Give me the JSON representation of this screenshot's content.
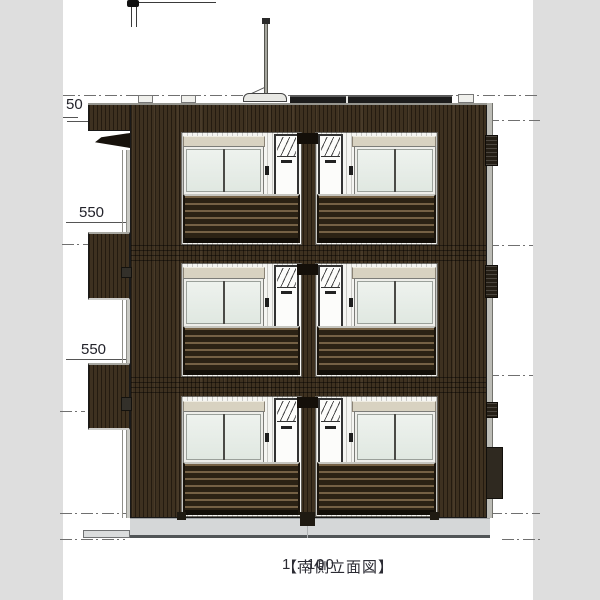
{
  "drawing": {
    "title": "【南側立面図】",
    "scale": "1 : 100",
    "dimensions": {
      "parapet": "50",
      "floor3": "550",
      "floor2": "550"
    },
    "colors": {
      "facade": "#3e3120",
      "railing": "#2b2214",
      "shutter_box": "#d8d2c1",
      "window_glass": "#e6ece6",
      "foundation": "#d5d7d8",
      "paper": "#ffffff",
      "margin": "#dedede"
    }
  }
}
